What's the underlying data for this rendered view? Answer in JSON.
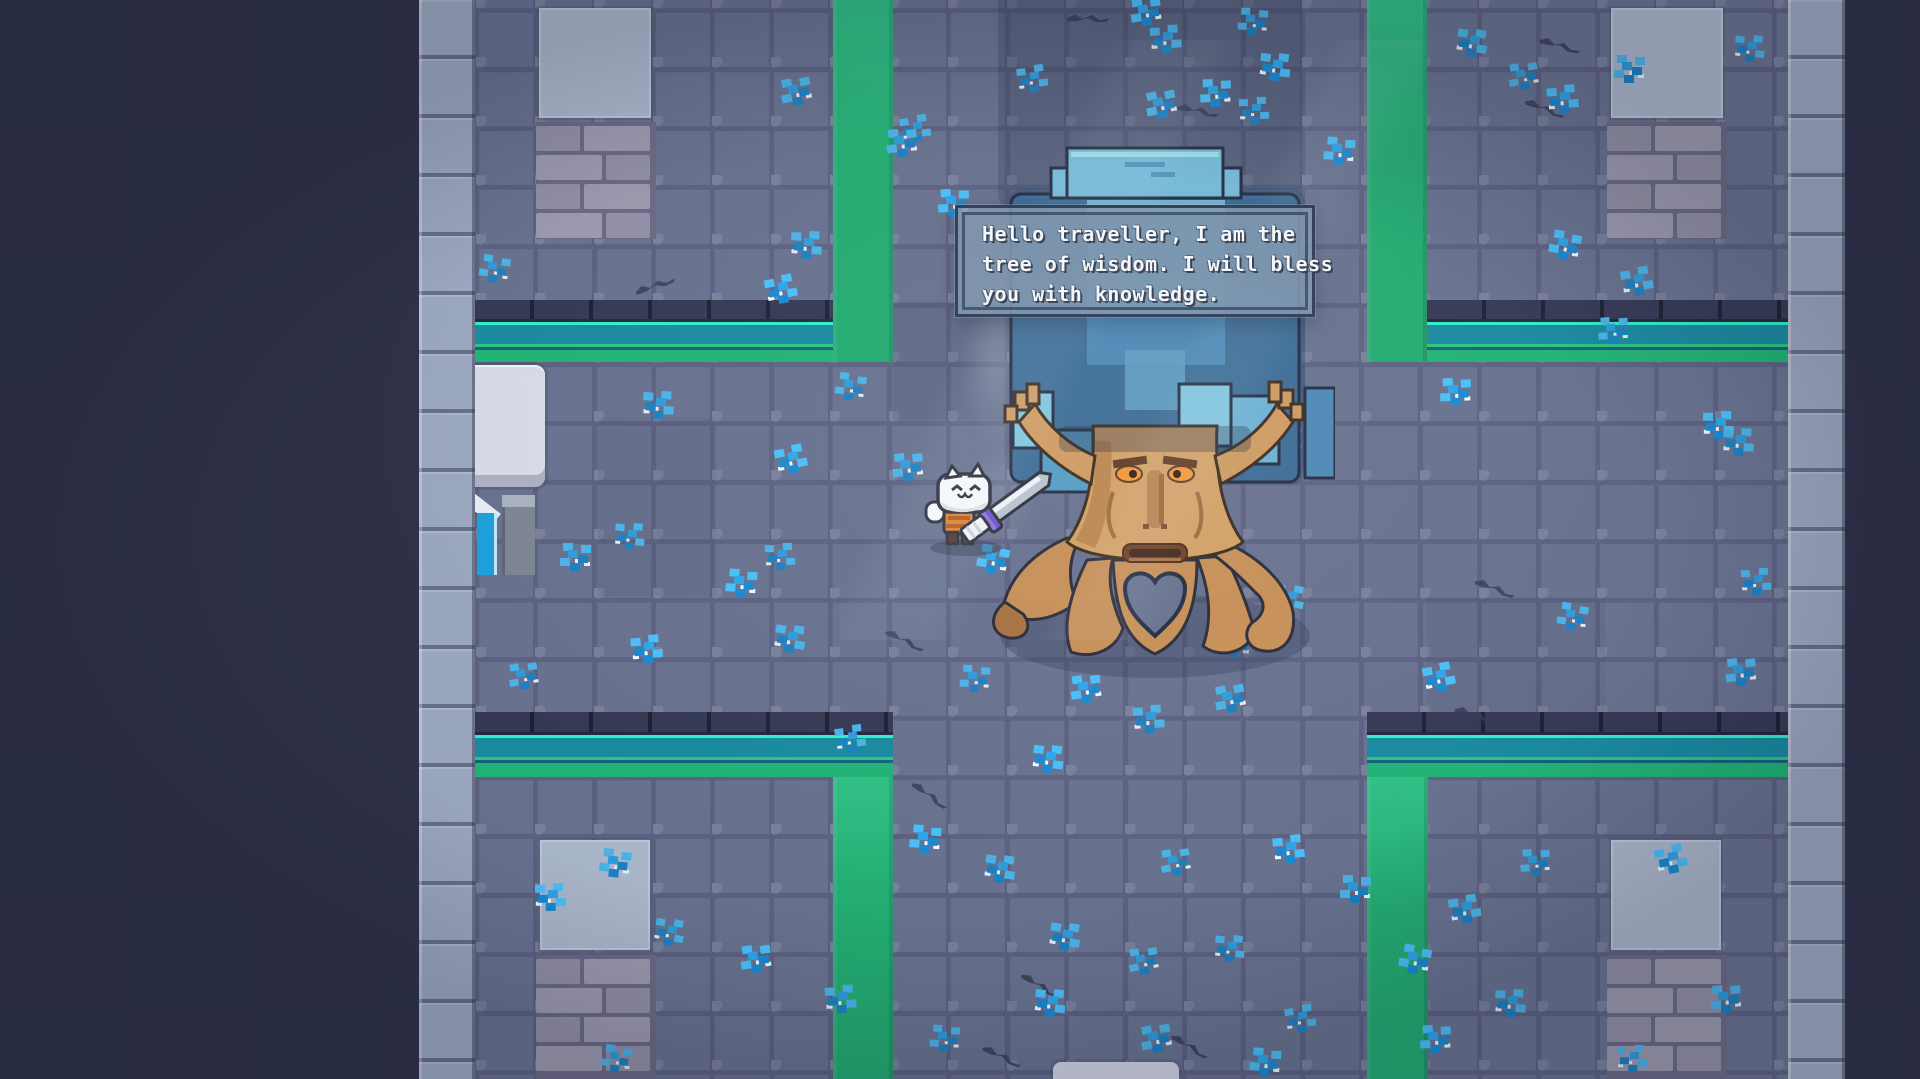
{
  "game": {
    "dialog": {
      "lines": [
        "Hello traveller, I am the",
        "tree of wisdom. I will bless",
        "you with knowledge."
      ],
      "text": "Hello traveller, I am the tree of wisdom. I will bless you with knowledge."
    },
    "entities": {
      "npc": "tree-of-wisdom",
      "player": "white-cat-adventurer-with-sword"
    },
    "colors": {
      "floor": "#67718e",
      "grid_line": "#5b6080",
      "sidebar": "#2d3047",
      "stone_column": "#9aa6be",
      "strip_green": "#23aa70",
      "teal_band": "#18899e",
      "cyan_line": "#2defc6",
      "green_band": "#20b274",
      "wall_navy": "#343853",
      "brick": "#908ea4",
      "mortar": "#6a6884",
      "window": "#a9b5c9",
      "particle_blue": "#2f9ad8",
      "particle_light": "#49b2e6",
      "canopy_dark": "#3b6b94",
      "canopy_light": "#74b8d6",
      "trunk_tan": "#cf9a60",
      "eye_orange": "#f29536",
      "sword_purple": "#6a4fc8",
      "pants_orange": "#e0802f",
      "dialog_bg": "rgba(125,148,172,0.88)",
      "dialog_border": "#2c3b54",
      "dialog_text": "#f4f7fa"
    },
    "particles": [
      [
        800,
        95
      ],
      [
        925,
        132
      ],
      [
        958,
        206
      ],
      [
        816,
        248
      ],
      [
        500,
        272
      ],
      [
        790,
        292
      ],
      [
        906,
        146
      ],
      [
        1264,
        114
      ],
      [
        1344,
        154
      ],
      [
        1482,
        46
      ],
      [
        1528,
        80
      ],
      [
        1572,
        102
      ],
      [
        1634,
        72
      ],
      [
        1760,
        52
      ],
      [
        1570,
        248
      ],
      [
        1646,
        284
      ],
      [
        1618,
        334
      ],
      [
        1728,
        428
      ],
      [
        1252,
        448
      ],
      [
        1298,
        444
      ],
      [
        1150,
        15
      ],
      [
        1175,
        42
      ],
      [
        1258,
        25
      ],
      [
        1285,
        70
      ],
      [
        1165,
        108
      ],
      [
        1042,
        82
      ],
      [
        1220,
        96
      ],
      [
        668,
        408
      ],
      [
        856,
        390
      ],
      [
        800,
        462
      ],
      [
        912,
        470
      ],
      [
        790,
        560
      ],
      [
        746,
        586
      ],
      [
        800,
        642
      ],
      [
        528,
        680
      ],
      [
        656,
        652
      ],
      [
        580,
        560
      ],
      [
        640,
        540
      ],
      [
        998,
        562
      ],
      [
        1058,
        600
      ],
      [
        1104,
        642
      ],
      [
        1176,
        612
      ],
      [
        1240,
        646
      ],
      [
        1300,
        602
      ],
      [
        1090,
        692
      ],
      [
        1158,
        722
      ],
      [
        980,
        682
      ],
      [
        1058,
        762
      ],
      [
        1234,
        702
      ],
      [
        860,
        742
      ],
      [
        1460,
        395
      ],
      [
        1748,
        445
      ],
      [
        1578,
        620
      ],
      [
        1448,
        680
      ],
      [
        1745,
        675
      ],
      [
        1766,
        585
      ],
      [
        930,
        842
      ],
      [
        1010,
        872
      ],
      [
        1180,
        866
      ],
      [
        1298,
        852
      ],
      [
        1360,
        892
      ],
      [
        1240,
        952
      ],
      [
        1420,
        962
      ],
      [
        1474,
        912
      ],
      [
        1540,
        866
      ],
      [
        560,
        900
      ],
      [
        620,
        866
      ],
      [
        680,
        936
      ],
      [
        760,
        962
      ],
      [
        850,
        1002
      ],
      [
        950,
        1042
      ],
      [
        1060,
        1006
      ],
      [
        1160,
        1042
      ],
      [
        1310,
        1022
      ],
      [
        1440,
        1042
      ],
      [
        1520,
        1006
      ],
      [
        622,
        1062
      ],
      [
        1680,
        862
      ],
      [
        1730,
        1002
      ],
      [
        1642,
        1062
      ],
      [
        1270,
        1065
      ],
      [
        1075,
        940
      ],
      [
        1148,
        965
      ]
    ],
    "cracks": [
      [
        655,
        285,
        -15
      ],
      [
        1560,
        45,
        20
      ],
      [
        1545,
        108,
        25
      ],
      [
        1312,
        408,
        10
      ],
      [
        1040,
        985,
        35
      ],
      [
        1002,
        1056,
        30
      ],
      [
        1190,
        1046,
        35
      ],
      [
        930,
        795,
        40
      ],
      [
        1088,
        18,
        5
      ],
      [
        1475,
        714,
        20
      ],
      [
        905,
        640,
        30
      ],
      [
        1198,
        110,
        15
      ],
      [
        1495,
        588,
        25
      ]
    ]
  }
}
